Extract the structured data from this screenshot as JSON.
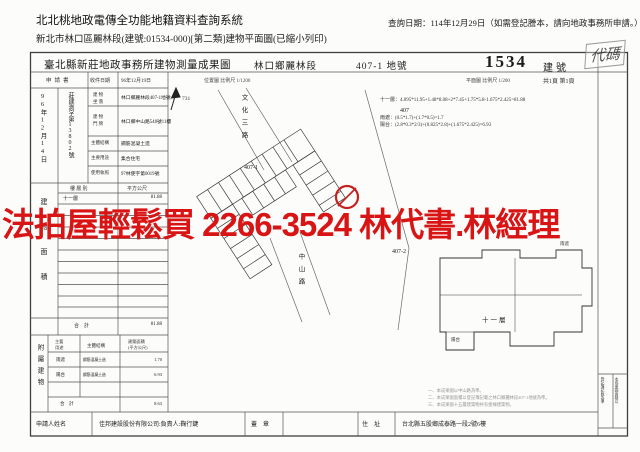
{
  "header": {
    "system_title": "北北桃地政電傳全功能地籍資料查詢系統",
    "doc_line": "新北市林口區麗林段(建號:01534-000)[第二類]建物平面圖(已縮小列印)",
    "query_date": "查詢日期：114年12月29日（如需登記謄本，請向地政事務所申請。）"
  },
  "watermark": {
    "text": "法拍屋輕鬆買 2266-3524 林代書.林經理",
    "color": "#d81414"
  },
  "form": {
    "title": "臺北縣新莊地政事務所建物測量成果圖",
    "district": "林口鄉麗林段",
    "parcel_no": "407-1 地號",
    "building_no": "1534",
    "building_no_label": "建號",
    "stamp_text": "代碼",
    "meta": {
      "application_label": "申請書",
      "receive_date_label": "收件日期",
      "receive_date": "96年12月19日",
      "location_scale": "位置圖 比例尺 1/1200",
      "floorplan_scale": "平面圖 比例尺 1/200",
      "page_info": "共1頁 第1頁",
      "survey_date": "96年12月14日",
      "file_no": "莊建測字第13802號"
    },
    "fields": [
      {
        "label": "建 物\n坐 落",
        "value": "林口鄉麗林段407-1地號"
      },
      {
        "label": "建 物\n門 牌",
        "value": "林口鄉中山路548號11樓"
      },
      {
        "label": "主體結構",
        "value": "鋼筋混凝土造"
      },
      {
        "label": "主要用途",
        "value": "集合住宅"
      },
      {
        "label": "使用執照",
        "value": "97林使字第0019號"
      }
    ],
    "floor_area": {
      "side_label": "建物面積",
      "col_floor": "樓 層 別",
      "col_area": "平方公尺",
      "floor": "十一層",
      "area": "81.88",
      "total_label": "合　計",
      "total": "81.88"
    },
    "annex": {
      "side_label": "附屬建物",
      "col_use": "主要\n用途",
      "col_structure": "主體結構",
      "col_area": "建築面積\n(平方公尺)",
      "rows": [
        {
          "use": "雨遮",
          "structure": "鋼筋混凝土造",
          "area": "1.70"
        },
        {
          "use": "陽台",
          "structure": "鋼筋混凝土造",
          "area": "6.93"
        }
      ],
      "total_label": "合　計",
      "total": "8.63"
    },
    "applicant": {
      "name_label": "申請人姓名",
      "name": "佳邦建設股份有限公司:負責人:鞠行鍵",
      "seal_label": "蓋　章",
      "address_label": "住　址",
      "address": "台北縣五股鄉成泰路一段2號6樓"
    },
    "margin_note": {
      "col1": "本成果圖面積以",
      "col2": "登記簿記載為準"
    },
    "notes": [
      "一、本成果圖以中山路為準。",
      "二、本成果圖面積以登記簿記載之林口鄉麗林段407-1地號為準。",
      "三、本成果圖十五層建築物共有壹棟建築物。"
    ]
  },
  "plan": {
    "north_number": "731",
    "road_vertical_1": "文化三路",
    "road_vertical_2": "中山路",
    "lot_main": "407",
    "lot_sub1": "407-1",
    "lot_sub2": "407-2",
    "unit_floor_label": "十一層",
    "balcony_label": "陽台",
    "canopy_label": "雨遮",
    "formulas": [
      "十一層：4.095*11.95+1.48*8.08+2*7.45+1.75*5.8-1.675*2.425=81.88",
      "雨遮：(0.5*1.7)+(1.7*0.5)=1.7",
      "陽台：(2.8*0.3*2/3)+(0.825*2.8)+(1.675*2.425)=6.93"
    ]
  }
}
